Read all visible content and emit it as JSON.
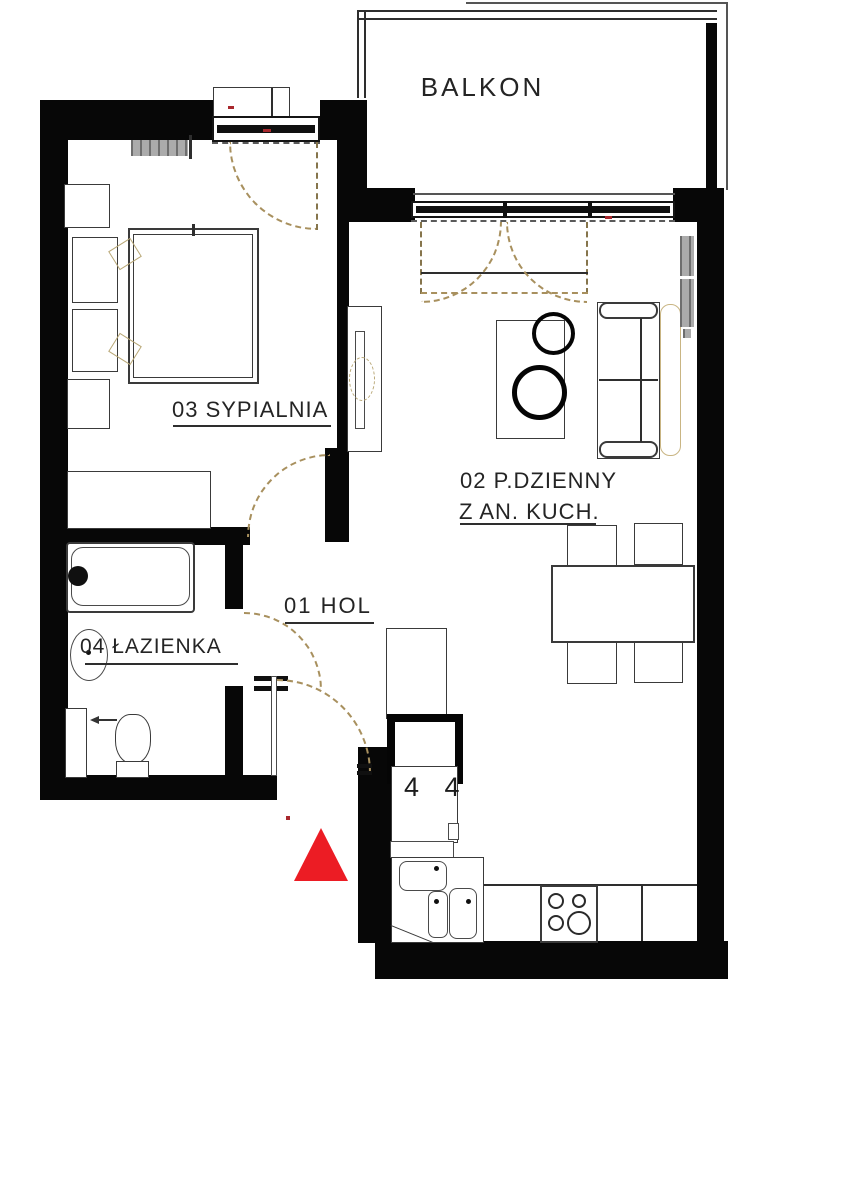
{
  "rooms": {
    "balcony": {
      "label": "BALKON"
    },
    "bedroom": {
      "label": "03 SYPIALNIA"
    },
    "living": {
      "label_line1": "02 P.DZIENNY",
      "label_line2": "Z AN. KUCH."
    },
    "hall": {
      "label": "01 HOL"
    },
    "bathroom": {
      "label": "04 ŁAZIENKA"
    }
  },
  "kitchen": {
    "fridge_marks": "4 4"
  },
  "colors": {
    "wall": "#070707",
    "entrance_marker_red": "#ec1c24",
    "door_swing_dash": "#a8905e",
    "radiator_gray": "#ababab",
    "label_text": "#242424"
  }
}
